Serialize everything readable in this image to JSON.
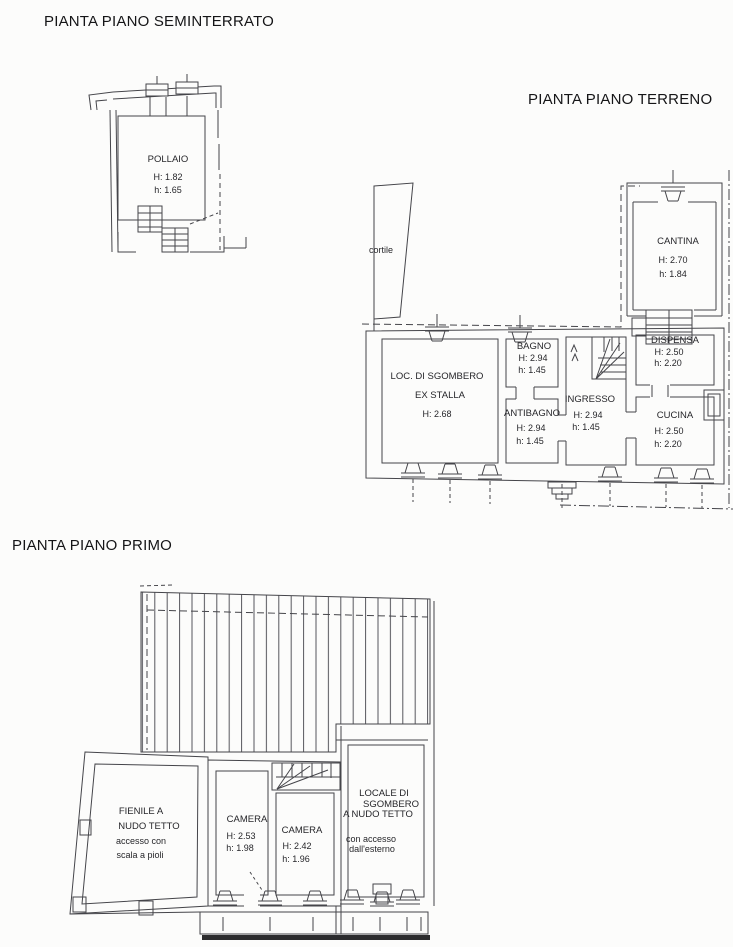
{
  "colors": {
    "ink": "#45454a",
    "paper": "#fcfcfb",
    "roof_hatch": "#55555c",
    "thick_bar": "#2c2c2e"
  },
  "plans": {
    "seminterrato": {
      "title": "PIANTA PIANO SEMINTERRATO",
      "rooms": {
        "pollaio": {
          "name": "POLLAIO",
          "H": "H: 1.82",
          "h": "h: 1.65"
        }
      }
    },
    "terreno": {
      "title": "PIANTA PIANO TERRENO",
      "areas": {
        "cortile": "cortile"
      },
      "rooms": {
        "cantina": {
          "name": "CANTINA",
          "H": "H: 2.70",
          "h": "h: 1.84"
        },
        "sgombero": {
          "line1": "LOC. DI SGOMBERO",
          "line2": "EX STALLA",
          "H": "H: 2.68"
        },
        "bagno": {
          "name": "BAGNO",
          "H": "H: 2.94",
          "h": "h: 1.45"
        },
        "antibagno": {
          "name": "ANTIBAGNO",
          "H": "H: 2.94",
          "h": "h: 1.45"
        },
        "ingresso": {
          "name": "INGRESSO",
          "H": "H: 2.94",
          "h": "h: 1.45"
        },
        "dispensa": {
          "name": "DISPENSA",
          "H": "H: 2.50",
          "h": "h: 2.20"
        },
        "cucina": {
          "name": "CUCINA",
          "H": "H: 2.50",
          "h": "h: 2.20"
        }
      }
    },
    "primo": {
      "title": "PIANTA PIANO PRIMO",
      "rooms": {
        "fienile": {
          "line1": "FIENILE A",
          "line2": "NUDO TETTO",
          "note1": "accesso con",
          "note2": "scala a pioli"
        },
        "camera1": {
          "name": "CAMERA",
          "H": "H: 2.53",
          "h": "h: 1.98"
        },
        "camera2": {
          "name": "CAMERA",
          "H": "H: 2.42",
          "h": "h: 1.96"
        },
        "locale": {
          "line1": "LOCALE DI",
          "line2": "SGOMBERO",
          "line3": "A NUDO TETTO",
          "note1": "con accesso",
          "note2": "dall'esterno"
        }
      }
    }
  }
}
